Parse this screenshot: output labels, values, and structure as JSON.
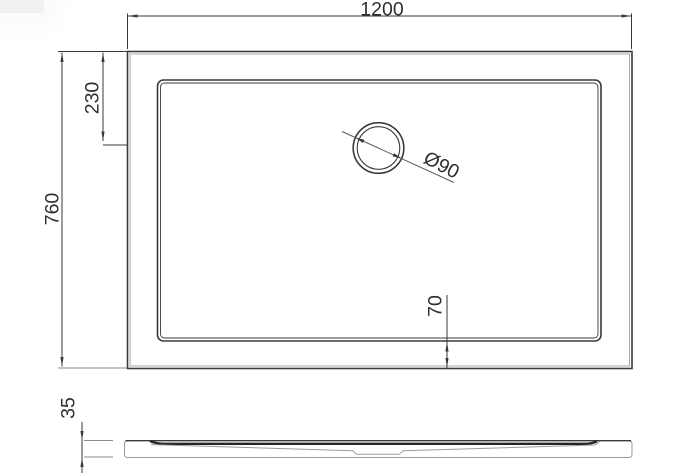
{
  "drawing": {
    "type": "technical-drawing",
    "subject": "rectangular shower tray, plan view and side elevation",
    "colors": {
      "background": "#ffffff",
      "primary_line": "#3a3a3a",
      "secondary_line": "#9e9e9e",
      "text": "#2f2f2f"
    },
    "dimensions": {
      "overall_width": {
        "label": "1200"
      },
      "overall_depth": {
        "label": "760"
      },
      "drain_from_top": {
        "label": "230"
      },
      "rim_to_edge": {
        "label": "70"
      },
      "drain_diameter": {
        "label": "Ø90"
      },
      "tray_height": {
        "label": "35"
      }
    }
  }
}
